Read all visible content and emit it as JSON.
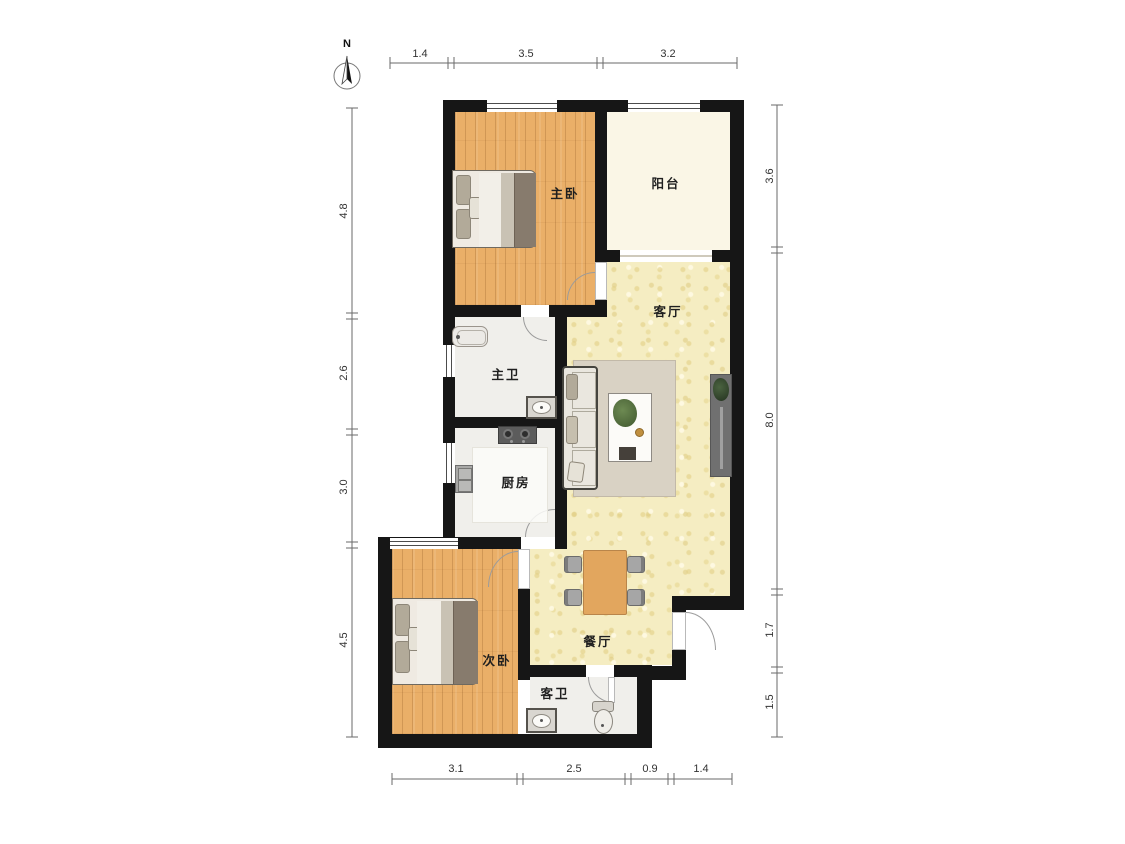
{
  "compass": {
    "label": "N"
  },
  "rooms": {
    "master_bedroom": "主卧",
    "balcony": "阳台",
    "living_room": "客厅",
    "master_bath": "主卫",
    "kitchen": "厨房",
    "second_bedroom": "次卧",
    "dining_room": "餐厅",
    "guest_bath": "客卫"
  },
  "dimensions": {
    "top": [
      "1.4",
      "3.5",
      "3.2"
    ],
    "left": [
      "4.8",
      "2.6",
      "3.0",
      "4.5"
    ],
    "right": [
      "3.6",
      "8.0",
      "1.7",
      "1.5"
    ],
    "bottom": [
      "3.1",
      "2.5",
      "0.9",
      "1.4"
    ]
  },
  "colors": {
    "wall": "#161616",
    "wood_floor": "#eaaf68",
    "hall_floor": "#f5edc2",
    "balcony_floor": "#faf6e6",
    "tile_floor": "#f0efeb",
    "rug": "#d9d2c4",
    "dark_blanket": "#877b6d",
    "door_arc": "#9b9b9b",
    "window_line": "#4c4c4c",
    "dim_text": "#333333",
    "label_text": "#1f1f1f"
  }
}
